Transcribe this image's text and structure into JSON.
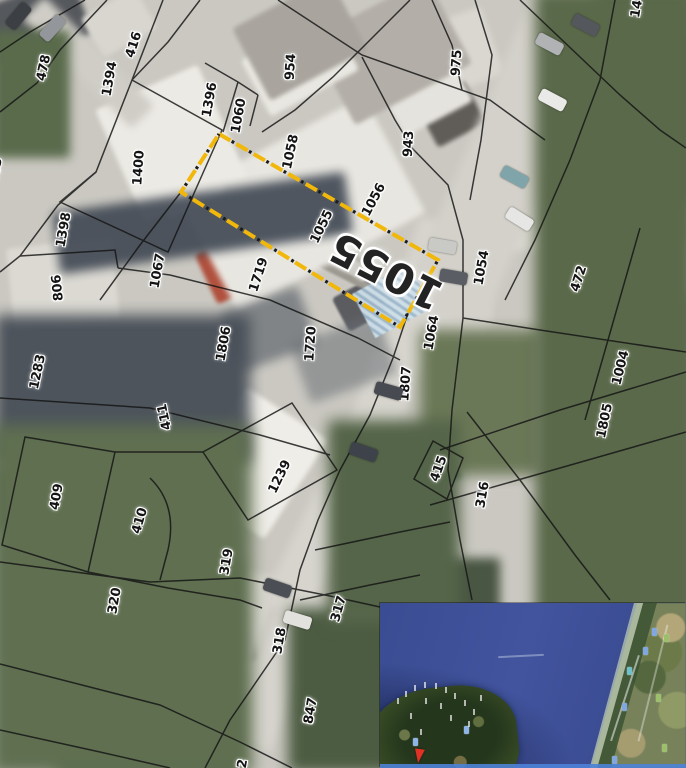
{
  "map": {
    "type": "cadastral-aerial-overlay",
    "boundary_line_color": "#141414",
    "highlighted_parcel": {
      "number": "1055",
      "outline_points": "219,134 438,260 400,327 181,192",
      "outline_color": "#f1b70a",
      "outline_dot_color": "#1c1c1c",
      "big_label": {
        "text": "1055",
        "x": 386,
        "y": 271,
        "rotation": 207,
        "size": 42
      }
    },
    "parcel_labels": [
      {
        "n": "403",
        "x": -4,
        "y": 171,
        "r": -80
      },
      {
        "n": "478",
        "x": 44,
        "y": 68,
        "r": -78
      },
      {
        "n": "416",
        "x": 134,
        "y": 45,
        "r": -72
      },
      {
        "n": "1394",
        "x": 110,
        "y": 79,
        "r": -80
      },
      {
        "n": "954",
        "x": 291,
        "y": 67,
        "r": -86
      },
      {
        "n": "975",
        "x": 457,
        "y": 63,
        "r": -86
      },
      {
        "n": "14",
        "x": 637,
        "y": 9,
        "r": -80
      },
      {
        "n": "1396",
        "x": 210,
        "y": 100,
        "r": -80
      },
      {
        "n": "1060",
        "x": 239,
        "y": 116,
        "r": -80
      },
      {
        "n": "1058",
        "x": 291,
        "y": 152,
        "r": -78
      },
      {
        "n": "943",
        "x": 409,
        "y": 144,
        "r": -87
      },
      {
        "n": "1400",
        "x": 139,
        "y": 168,
        "r": -86
      },
      {
        "n": "1056",
        "x": 374,
        "y": 200,
        "r": -62
      },
      {
        "n": "1055",
        "x": 322,
        "y": 227,
        "r": -64
      },
      {
        "n": "1398",
        "x": 64,
        "y": 230,
        "r": -80
      },
      {
        "n": "1067",
        "x": 158,
        "y": 271,
        "r": -80
      },
      {
        "n": "806",
        "x": 58,
        "y": 288,
        "r": -96
      },
      {
        "n": "1719",
        "x": 259,
        "y": 275,
        "r": -72
      },
      {
        "n": "1054",
        "x": 482,
        "y": 268,
        "r": -80
      },
      {
        "n": "472",
        "x": 579,
        "y": 279,
        "r": -72
      },
      {
        "n": "1064",
        "x": 432,
        "y": 333,
        "r": -80
      },
      {
        "n": "1806",
        "x": 224,
        "y": 344,
        "r": -80
      },
      {
        "n": "1720",
        "x": 311,
        "y": 344,
        "r": -86
      },
      {
        "n": "1283",
        "x": 38,
        "y": 372,
        "r": -78
      },
      {
        "n": "1807",
        "x": 406,
        "y": 384,
        "r": -86
      },
      {
        "n": "1004",
        "x": 621,
        "y": 368,
        "r": -76
      },
      {
        "n": "1805",
        "x": 605,
        "y": 421,
        "r": -78
      },
      {
        "n": "411",
        "x": 165,
        "y": 417,
        "r": -102
      },
      {
        "n": "409",
        "x": 57,
        "y": 497,
        "r": -80
      },
      {
        "n": "410",
        "x": 140,
        "y": 521,
        "r": -74
      },
      {
        "n": "1239",
        "x": 280,
        "y": 477,
        "r": -64
      },
      {
        "n": "415",
        "x": 439,
        "y": 469,
        "r": -70
      },
      {
        "n": "316",
        "x": 483,
        "y": 495,
        "r": -80
      },
      {
        "n": "319",
        "x": 227,
        "y": 562,
        "r": -80
      },
      {
        "n": "320",
        "x": 115,
        "y": 601,
        "r": -80
      },
      {
        "n": "317",
        "x": 339,
        "y": 609,
        "r": -74
      },
      {
        "n": "318",
        "x": 280,
        "y": 641,
        "r": -80
      },
      {
        "n": "847",
        "x": 311,
        "y": 711,
        "r": -80
      },
      {
        "n": "2",
        "x": 243,
        "y": 764,
        "r": -80
      }
    ],
    "vehicles": [
      {
        "x": 18,
        "y": 16,
        "r": 40,
        "c": "#3c4045"
      },
      {
        "x": 52,
        "y": 28,
        "r": 42,
        "c": "#93969a"
      },
      {
        "x": 585,
        "y": 25,
        "r": -62,
        "c": "#54575c"
      },
      {
        "x": 549,
        "y": 44,
        "r": -62,
        "c": "#b0b2b4"
      },
      {
        "x": 552,
        "y": 100,
        "r": -62,
        "c": "#e9e9e7"
      },
      {
        "x": 514,
        "y": 177,
        "r": -62,
        "c": "#7fa4aa"
      },
      {
        "x": 519,
        "y": 219,
        "r": -58,
        "c": "#e6e6e4"
      },
      {
        "x": 442,
        "y": 246,
        "r": -80,
        "c": "#c9c9c5"
      },
      {
        "x": 453,
        "y": 277,
        "r": -80,
        "c": "#5a5d63"
      },
      {
        "x": 388,
        "y": 391,
        "r": -74,
        "c": "#474a50"
      },
      {
        "x": 363,
        "y": 452,
        "r": -71,
        "c": "#3e424a"
      },
      {
        "x": 277,
        "y": 588,
        "r": -71,
        "c": "#4b4e54"
      },
      {
        "x": 297,
        "y": 620,
        "r": -73,
        "c": "#e2e1dd"
      }
    ]
  },
  "inset_map": {
    "sea_color": "#3f5198",
    "pin_color": "#e03224",
    "bottom_border_color": "#4d82d8",
    "markers": [
      {
        "x": 272,
        "y": 25,
        "color": "#7fa8e0"
      },
      {
        "x": 263,
        "y": 44,
        "color": "#7fa8e0"
      },
      {
        "x": 247,
        "y": 64,
        "color": "#6fc0c8"
      },
      {
        "x": 242,
        "y": 100,
        "color": "#7fa8e0"
      },
      {
        "x": 232,
        "y": 153,
        "color": "#7fa8e0"
      },
      {
        "x": 33,
        "y": 135,
        "color": "#8fb4e8"
      },
      {
        "x": 84,
        "y": 123,
        "color": "#8fb4e8"
      },
      {
        "x": 284,
        "y": 31,
        "color": "#9cc06a"
      },
      {
        "x": 276,
        "y": 91,
        "color": "#9cc06a"
      },
      {
        "x": 282,
        "y": 141,
        "color": "#9cc06a"
      }
    ],
    "place_specks": [
      [
        17,
        95
      ],
      [
        25,
        88
      ],
      [
        34,
        82
      ],
      [
        44,
        79
      ],
      [
        55,
        80
      ],
      [
        65,
        84
      ],
      [
        74,
        90
      ],
      [
        84,
        97
      ],
      [
        93,
        106
      ],
      [
        60,
        100
      ],
      [
        45,
        95
      ],
      [
        30,
        110
      ],
      [
        70,
        112
      ],
      [
        88,
        118
      ],
      [
        40,
        126
      ],
      [
        100,
        92
      ]
    ]
  }
}
